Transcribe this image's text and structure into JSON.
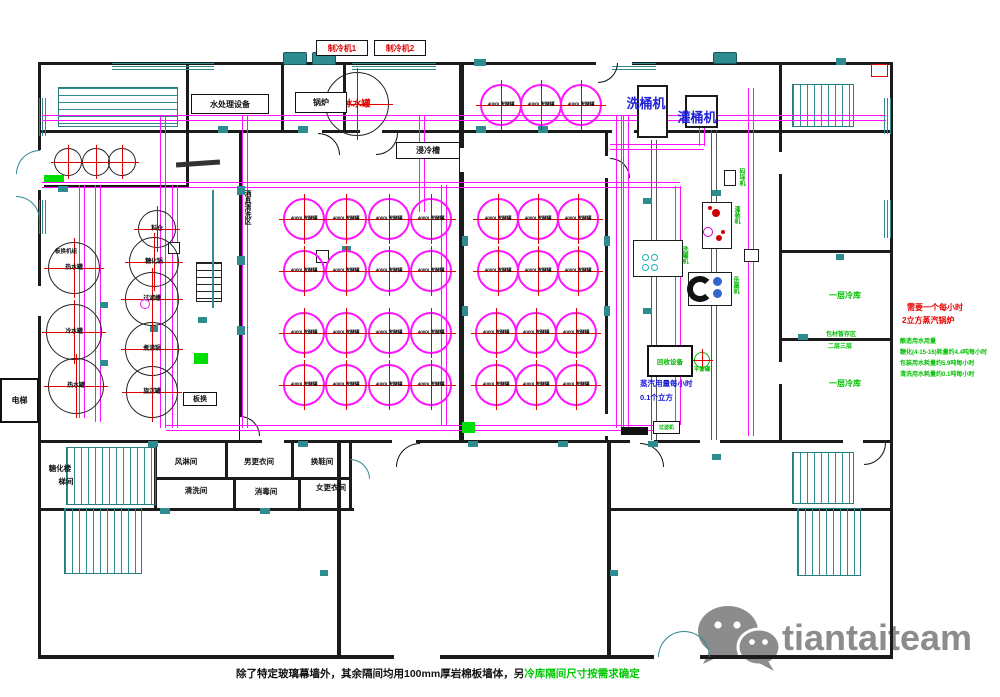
{
  "header": {
    "chiller1": "制冷机1",
    "chiller2": "制冷机2"
  },
  "equipment": {
    "water_treatment": "水处理设备",
    "boiler": "锅炉",
    "immersion_chiller": "浸冷槽"
  },
  "vessels": {
    "hot_water": "热水罐",
    "cold_water": "冷水罐",
    "ice_water": "冰水罐",
    "silo": "料仓",
    "mash_tun": "糖化锅",
    "lauter_tun": "过滤槽",
    "kettle": "煮沸锅",
    "whirlpool": "旋沉罐",
    "fermenter": "4000L发酵罐"
  },
  "machines": {
    "keg_washer": "洗桶机",
    "keg_filler": "灌桶机",
    "washer": "洗罐机",
    "filler": "灌装机",
    "pasteurizer": "杀菌机",
    "stacker": "码垛机",
    "filter": "过滤机",
    "recycle": "回收设备",
    "balance_tank": "平衡罐"
  },
  "rooms": {
    "air_shower": "风淋间",
    "men_changing": "男更衣间",
    "shoe_change": "换鞋间",
    "washing": "清洗间",
    "disinfection": "消毒间",
    "women_changing": "女更衣间"
  },
  "areas": {
    "wash_area": "酒具清洗区",
    "mash_stair_line1": "糖化楼",
    "mash_stair_line2": "梯间",
    "elevator": "电梯",
    "plate_hx": "板换",
    "plate_hx_unit": "板换机组",
    "cold_room_a": "一层冷库",
    "cold_room_b": "一层冷库",
    "packing_storage": "包材暂存区",
    "floor_2_3": "二层三层"
  },
  "annotations": {
    "red": [
      "需要一个每小时",
      "2立方蒸汽锅炉"
    ],
    "green": [
      "酿造用水用量",
      "糖化(4-15-16)耗量约4.4吨每小时",
      "包装用水耗量约5.9吨每小时",
      "清洗用水耗量约0.1吨每小时"
    ],
    "blue": [
      "蒸汽用量每小时",
      "0.1个立方"
    ]
  },
  "footnote": {
    "black": "除了特定玻璃幕墙外，其余隔间均用100mm厚岩棉板墙体，另",
    "green": "冷库隔间尺寸按需求确定"
  },
  "watermark": {
    "text": "tiantaiteam"
  }
}
